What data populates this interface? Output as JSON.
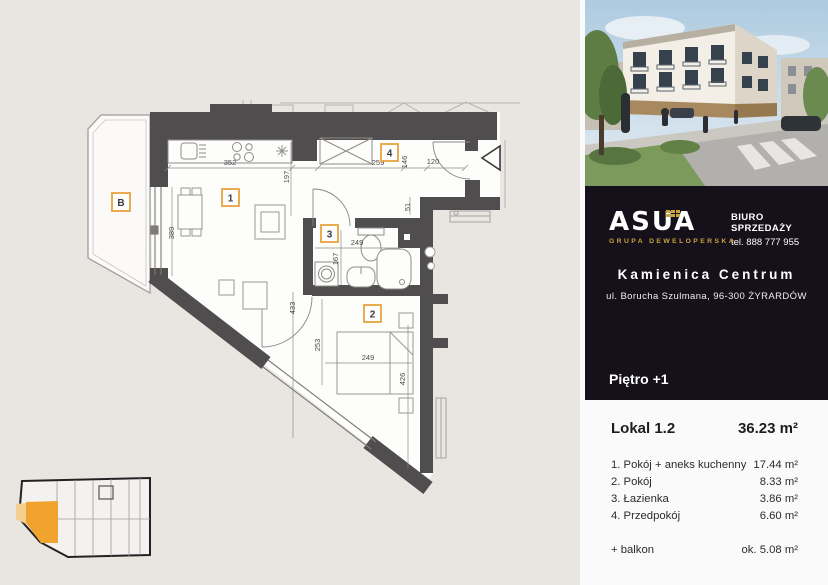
{
  "plan": {
    "labels": {
      "living": "1",
      "bedroom": "2",
      "bath": "3",
      "hall": "4",
      "balcony": "B"
    },
    "dims": {
      "kitchen_w": "352",
      "hall_w": "259",
      "w146": "146",
      "entry_w": "120",
      "w51": "51",
      "w197": "197",
      "window_h": "389",
      "living_h": "433",
      "bath_w": "249",
      "bath_h": "167",
      "bed_offset": "253",
      "bed_w": "249",
      "room2_h": "426"
    },
    "accent_color": "#e8a33c",
    "wall_color": "#504d4e"
  },
  "sidebar": {
    "logo": {
      "name": "ASUA",
      "tagline": "GRUPA DEWELOPERSKA",
      "gold": "#c9a43b"
    },
    "office": {
      "line1": "BIURO SPRZEDAŻY",
      "line2": "tel. 888 777 955"
    },
    "project": {
      "name": "Kamienica Centrum",
      "address": "ul. Borucha Szulmana, 96-300 ŻYRARDÓW"
    },
    "floor_label": "Piętro +1",
    "unit": {
      "label": "Lokal 1.2",
      "area": "36.23 m²"
    },
    "rooms": [
      {
        "name": "1. Pokój + aneks kuchenny",
        "area": "17.44 m²"
      },
      {
        "name": "2. Pokój",
        "area": "8.33 m²"
      },
      {
        "name": "3. Łazienka",
        "area": "3.86 m²"
      },
      {
        "name": "4. Przedpokój",
        "area": "6.60 m²"
      }
    ],
    "extra": {
      "name": "+ balkon",
      "area": "ok. 5.08 m²"
    }
  }
}
